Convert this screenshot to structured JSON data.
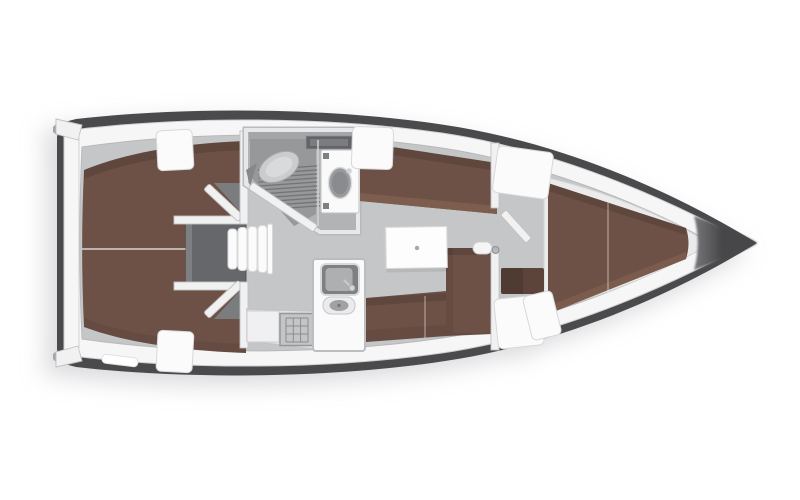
{
  "plan": {
    "kind": "sailing-yacht-interior-floor-plan",
    "orientation": "bow-right",
    "background": "#ffffff"
  },
  "colors": {
    "hull": "#4a4a4d",
    "bow_tip_dark": "#47474a",
    "bow_tip_light": "#77777a",
    "deck": "#f6f6f7",
    "deck_edge": "#cfcfd1",
    "sole": "#c5c6c8",
    "sole_edge": "#b7b8ba",
    "berth": "#6d5146",
    "berth_light": "#7d5e4e",
    "step_brown": "#5c443a",
    "engine_bay": "#66676a",
    "doorway_shadow": "#7b7c7e",
    "wall": "#f1f1f2",
    "wall_edge": "#c0c1c3",
    "head_floor": "#b2b3b5",
    "shower_pan": "#97989a",
    "grate_line": "#737477",
    "fixture_light": "#d3d4d6",
    "fixture_mid": "#a5a6a8",
    "fixture_dark": "#7e7f81",
    "porcelain": "#cbccce",
    "basin": "#9a9b9d",
    "sink_steel": "#aeafb1",
    "sink_well": "#7f8082",
    "stove": "#c4c5c7",
    "stove_line": "#8c8d8f",
    "table": "#fdfdfe",
    "divider_line": "#d8d4d1",
    "hatch": "#fbfbfc",
    "hatch_edge": "#d8d8da",
    "shadow": "rgba(120,120,130,0.28)"
  },
  "regions": [
    "hull",
    "transom",
    "side-deck",
    "cabin-sole",
    "aft-cabin-berth-port",
    "aft-cabin-berth-starboard",
    "engine-compartment",
    "companionway-steps",
    "aft-cabin-door-port",
    "aft-cabin-door-starboard",
    "head-compartment",
    "toilet",
    "shower-grate",
    "washbasin",
    "head-door",
    "galley",
    "galley-sink",
    "round-basin",
    "stove",
    "saloon",
    "saloon-table",
    "port-settee",
    "l-shaped-settee",
    "forward-cabin-bulkhead",
    "forward-cabin-door",
    "forward-step",
    "v-berth",
    "forward-lockers",
    "deck-hatches",
    "bow"
  ]
}
